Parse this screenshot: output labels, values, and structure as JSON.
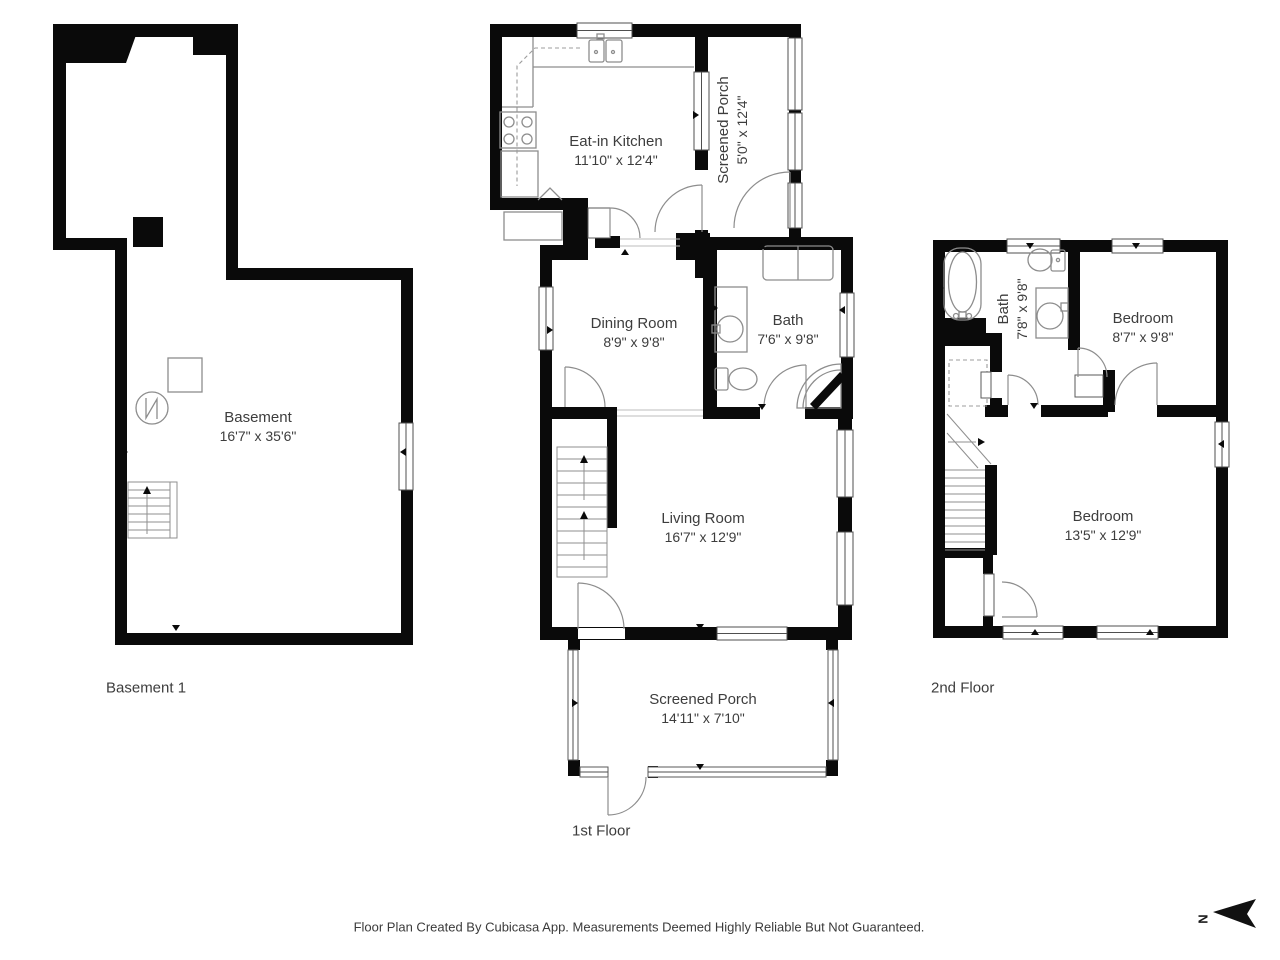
{
  "footer": "Floor Plan Created By Cubicasa App. Measurements Deemed Highly Reliable But Not Guaranteed.",
  "compass": {
    "north_label": "N"
  },
  "basement": {
    "floor_label": "Basement 1",
    "room": {
      "name": "Basement",
      "dims": "16'7\" x 35'6\""
    }
  },
  "first_floor": {
    "floor_label": "1st Floor",
    "kitchen": {
      "name": "Eat-in Kitchen",
      "dims": "11'10\" x 12'4\""
    },
    "porch_top": {
      "name": "Screened Porch",
      "dims": "5'0\" x 12'4\""
    },
    "dining": {
      "name": "Dining Room",
      "dims": "8'9\" x 9'8\""
    },
    "bath": {
      "name": "Bath",
      "dims": "7'6\" x 9'8\""
    },
    "living": {
      "name": "Living Room",
      "dims": "16'7\" x 12'9\""
    },
    "porch_bottom": {
      "name": "Screened Porch",
      "dims": "14'11\" x 7'10\""
    }
  },
  "second_floor": {
    "floor_label": "2nd Floor",
    "bath": {
      "name": "Bath",
      "dims": "7'8\" x 9'8\""
    },
    "bedroom_small": {
      "name": "Bedroom",
      "dims": "8'7\" x 9'8\""
    },
    "bedroom_large": {
      "name": "Bedroom",
      "dims": "13'5\" x 12'9\""
    }
  },
  "colors": {
    "wall": "#0a0a0a",
    "fixture": "#8d8d8d",
    "text": "#3d3d3d"
  }
}
